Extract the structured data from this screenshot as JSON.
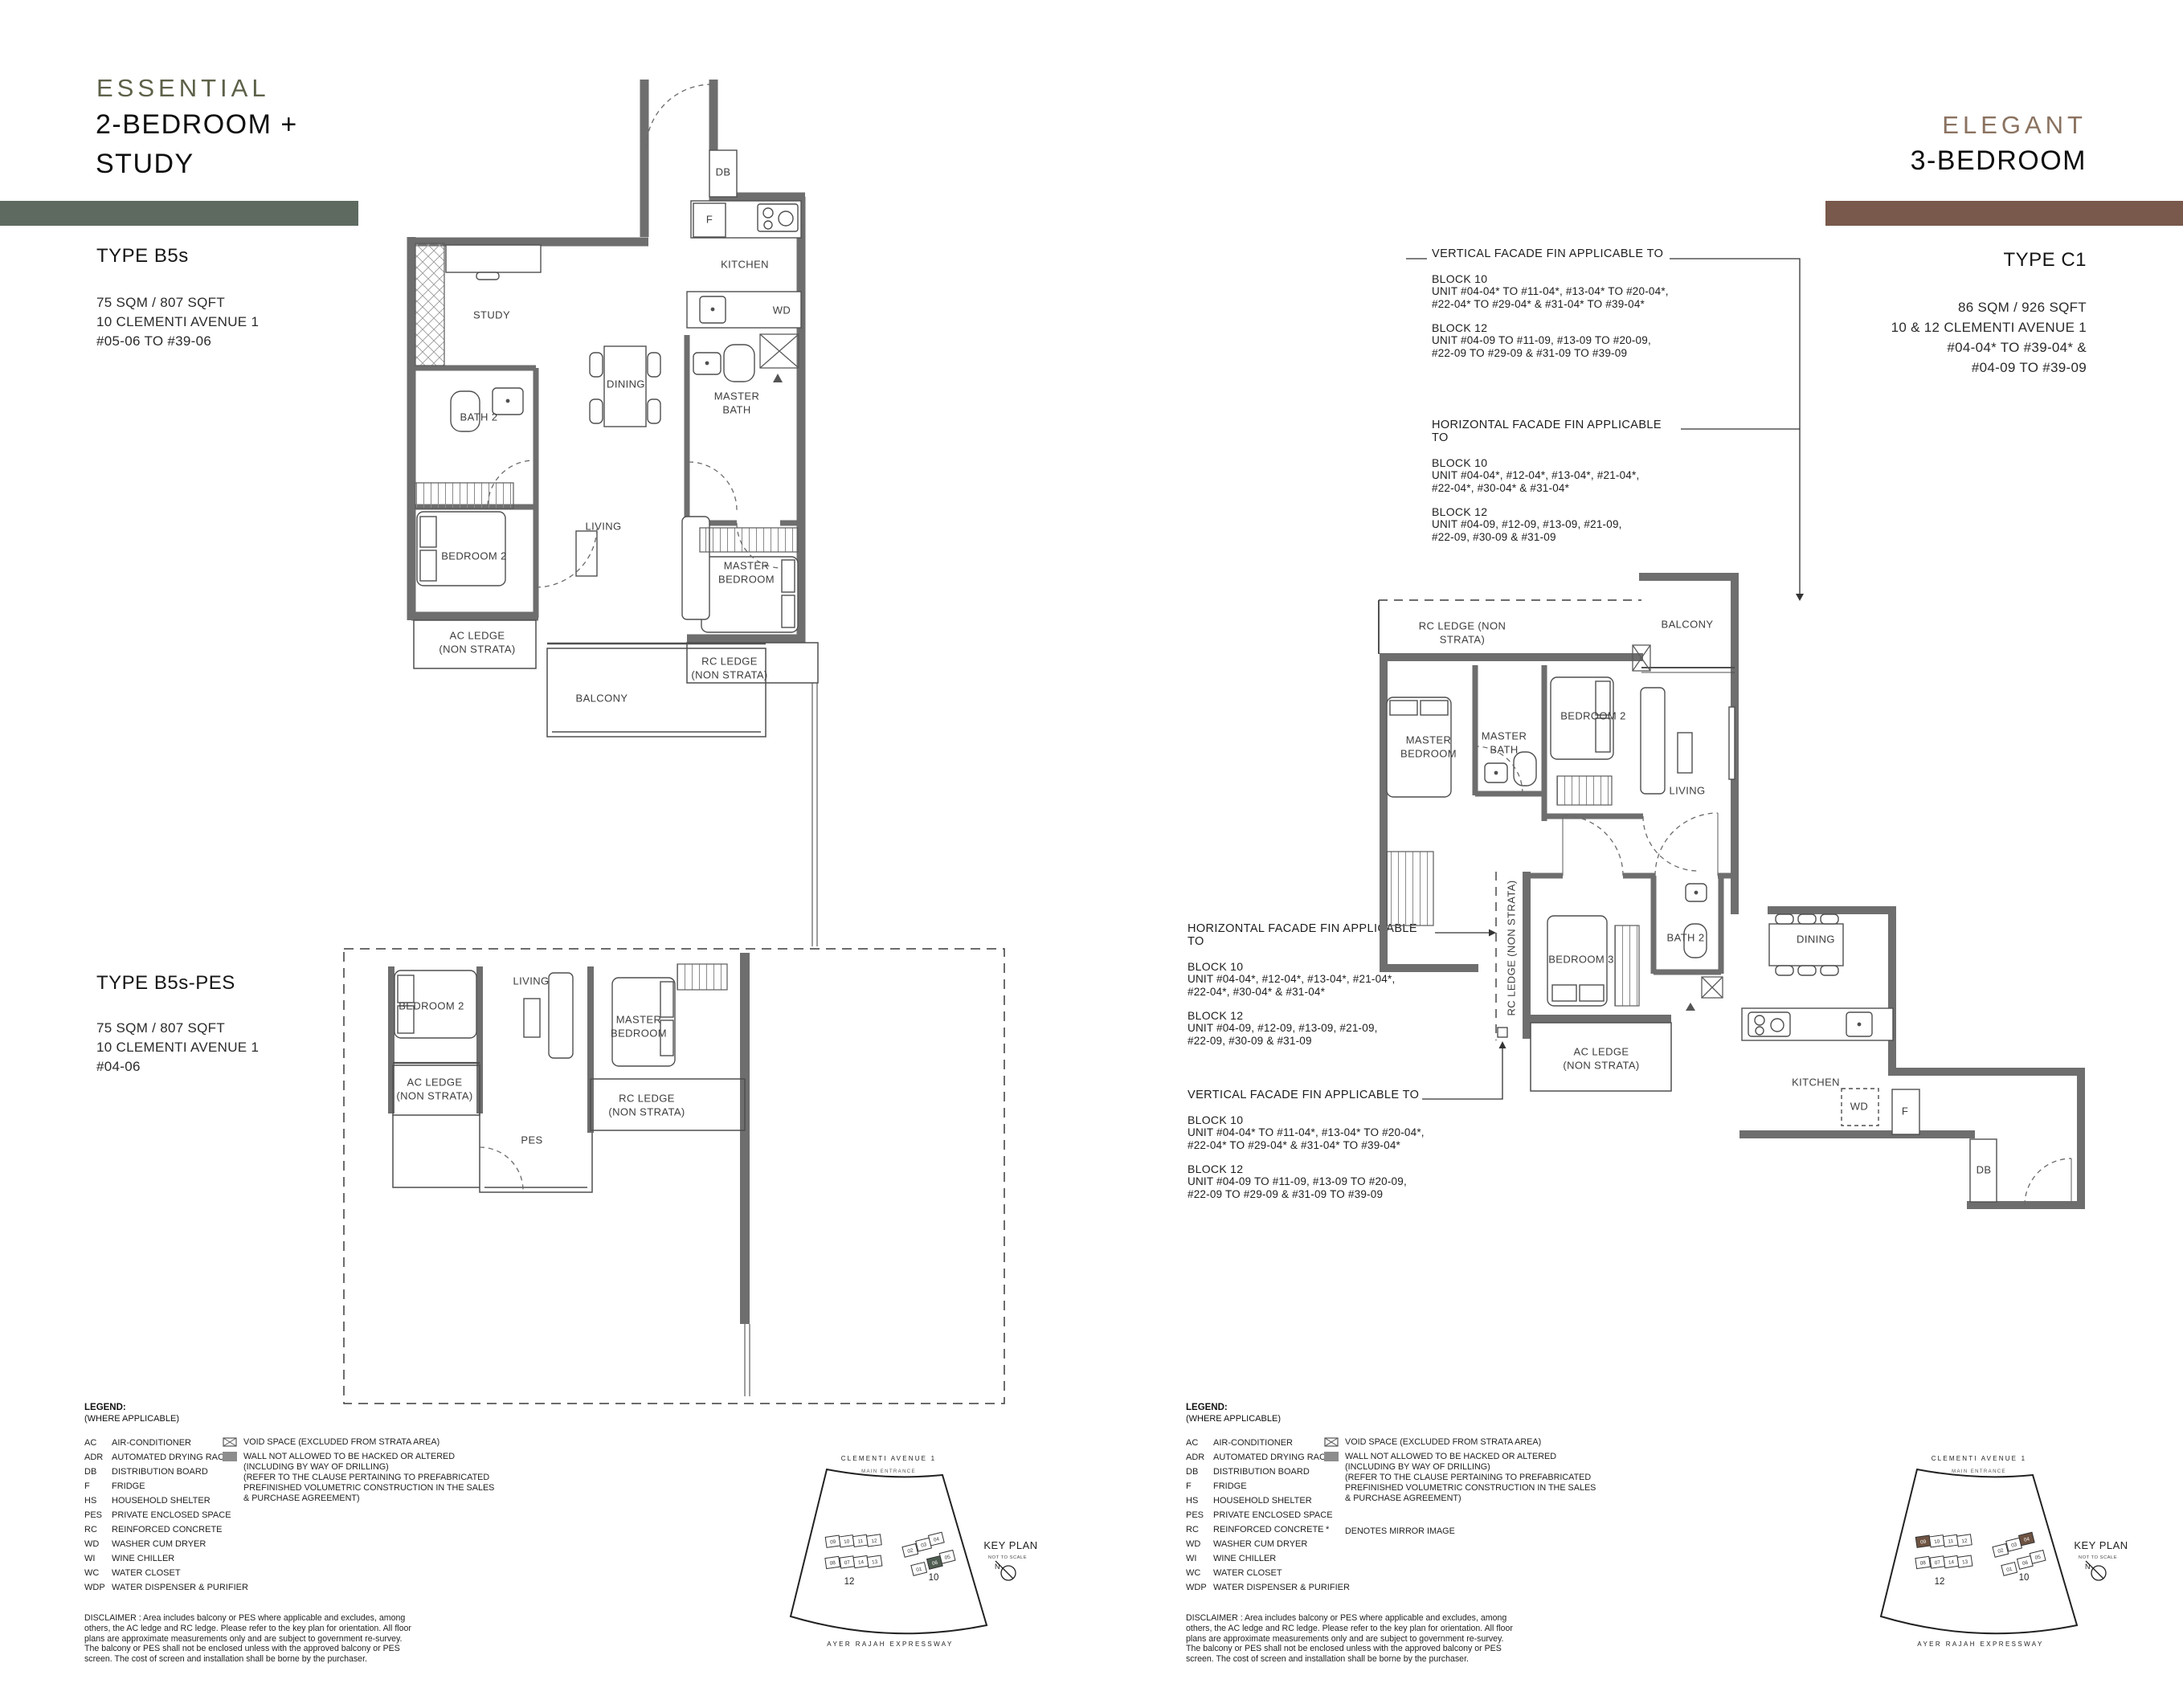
{
  "page": {
    "bg": "#ffffff",
    "wall_color": "#6e6e6e"
  },
  "left": {
    "collection": "ESSENTIAL",
    "accent": "#5c6148",
    "bar": "#5e6a60",
    "title1": "2-BEDROOM +",
    "title2": "STUDY",
    "b5s": {
      "name": "TYPE B5s",
      "area": "75 SQM / 807 SQFT",
      "address": "10 CLEMENTI AVENUE 1",
      "units": "#05-06 TO #39-06"
    },
    "pes": {
      "name": "TYPE B5s-PES",
      "area": "75 SQM / 807 SQFT",
      "address": "10 CLEMENTI AVENUE 1",
      "units": "#04-06"
    }
  },
  "right": {
    "collection": "ELEGANT",
    "accent": "#8a7260",
    "bar": "#78594b",
    "title1": "3-BEDROOM",
    "c1": {
      "name": "TYPE C1",
      "area": "86 SQM / 926 SQFT",
      "address": "10 & 12 CLEMENTI AVENUE 1",
      "units1": "#04-04* TO #39-04* &",
      "units2": "#04-09 TO #39-09"
    }
  },
  "facade": {
    "vertical_title": "VERTICAL FACADE FIN APPLICABLE TO",
    "horizontal_title": "HORIZONTAL FACADE FIN APPLICABLE TO",
    "block10": "BLOCK 10",
    "block12": "BLOCK 12",
    "v10": [
      "UNIT #04-04* TO #11-04*, #13-04* TO #20-04*,",
      "#22-04* TO #29-04* & #31-04* TO #39-04*"
    ],
    "v12": [
      "UNIT #04-09 TO #11-09, #13-09 TO #20-09,",
      "#22-09 TO #29-09 & #31-09 TO #39-09"
    ],
    "h10": [
      "UNIT #04-04*, #12-04*, #13-04*, #21-04*,",
      "#22-04*, #30-04* & #31-04*"
    ],
    "h12": [
      "UNIT #04-09, #12-09, #13-09, #21-09,",
      "#22-09, #30-09 & #31-09"
    ]
  },
  "rooms": {
    "b5s": {
      "db": "DB",
      "f": "F",
      "kitchen": "KITCHEN",
      "wd": "WD",
      "study": "STUDY",
      "bath2": "BATH 2",
      "dining": "DINING",
      "master_bath": "MASTER BATH",
      "bedroom2": "BEDROOM 2",
      "living": "LIVING",
      "master_bedroom": "MASTER BEDROOM",
      "ac_ledge": "AC LEDGE (NON STRATA)",
      "rc_ledge": "RC LEDGE (NON STRATA)",
      "balcony": "BALCONY"
    },
    "pes": {
      "bedroom2": "BEDROOM 2",
      "living": "LIVING",
      "master_bedroom": "MASTER BEDROOM",
      "ac_ledge": "AC LEDGE (NON STRATA)",
      "rc_ledge": "RC LEDGE (NON STRATA)",
      "pes": "PES"
    },
    "c1": {
      "rc_ledge_top": "RC LEDGE (NON STRATA)",
      "balcony": "BALCONY",
      "master_bedroom": "MASTER BEDROOM",
      "master_bath": "MASTER BATH",
      "bedroom2": "BEDROOM 2",
      "living": "LIVING",
      "rc_ledge_side": "RC LEDGE (NON STRATA)",
      "bedroom3": "BEDROOM 3",
      "bath2": "BATH 2",
      "dining": "DINING",
      "ac_ledge": "AC LEDGE (NON STRATA)",
      "kitchen": "KITCHEN",
      "wd": "WD",
      "f": "F",
      "db": "DB"
    }
  },
  "legend": {
    "title": "LEGEND:",
    "subtitle": "(WHERE APPLICABLE)",
    "items": [
      [
        "AC",
        "AIR-CONDITIONER"
      ],
      [
        "ADR",
        "AUTOMATED DRYING RACK"
      ],
      [
        "DB",
        "DISTRIBUTION BOARD"
      ],
      [
        "F",
        "FRIDGE"
      ],
      [
        "HS",
        "HOUSEHOLD SHELTER"
      ],
      [
        "PES",
        "PRIVATE ENCLOSED SPACE"
      ],
      [
        "RC",
        "REINFORCED CONCRETE"
      ],
      [
        "WD",
        "WASHER CUM DRYER"
      ],
      [
        "WI",
        "WINE CHILLER"
      ],
      [
        "WC",
        "WATER CLOSET"
      ],
      [
        "WDP",
        "WATER DISPENSER & PURIFIER"
      ]
    ],
    "void_note": "VOID SPACE (EXCLUDED FROM STRATA AREA)",
    "wall_note": [
      "WALL NOT ALLOWED TO BE HACKED OR ALTERED",
      "(INCLUDING BY WAY OF DRILLING)",
      "(REFER TO THE CLAUSE PERTAINING TO PREFABRICATED",
      "PREFINISHED VOLUMETRIC CONSTRUCTION IN THE SALES",
      "& PURCHASE AGREEMENT)"
    ],
    "mirror_mark": "*",
    "mirror_note": "DENOTES MIRROR IMAGE"
  },
  "disclaimer": "DISCLAIMER : Area includes balcony or PES where applicable and excludes, among others, the AC ledge and RC ledge. Please refer to the key plan for orientation. All floor plans are approximate measurements only and are subject to government re-survey. The balcony or PES shall not be enclosed unless with the approved balcony or PES screen. The cost of screen and installation shall be borne by the purchaser.",
  "keyplan": {
    "street_top": "CLEMENTI  AVENUE  1",
    "entrance": "MAIN  ENTRANCE",
    "street_bottom": "AYER   RAJAH   EXPRESSWAY",
    "title": "KEY PLAN",
    "subtitle": "NOT TO SCALE",
    "north": "N",
    "b12": "12",
    "b10": "10",
    "b12_units": [
      "09",
      "10",
      "11",
      "12",
      "08",
      "07",
      "14",
      "13"
    ],
    "b10_units": [
      "02",
      "03",
      "04",
      "01",
      "06",
      "05"
    ],
    "green": "#50604f",
    "brown": "#6e5342"
  }
}
